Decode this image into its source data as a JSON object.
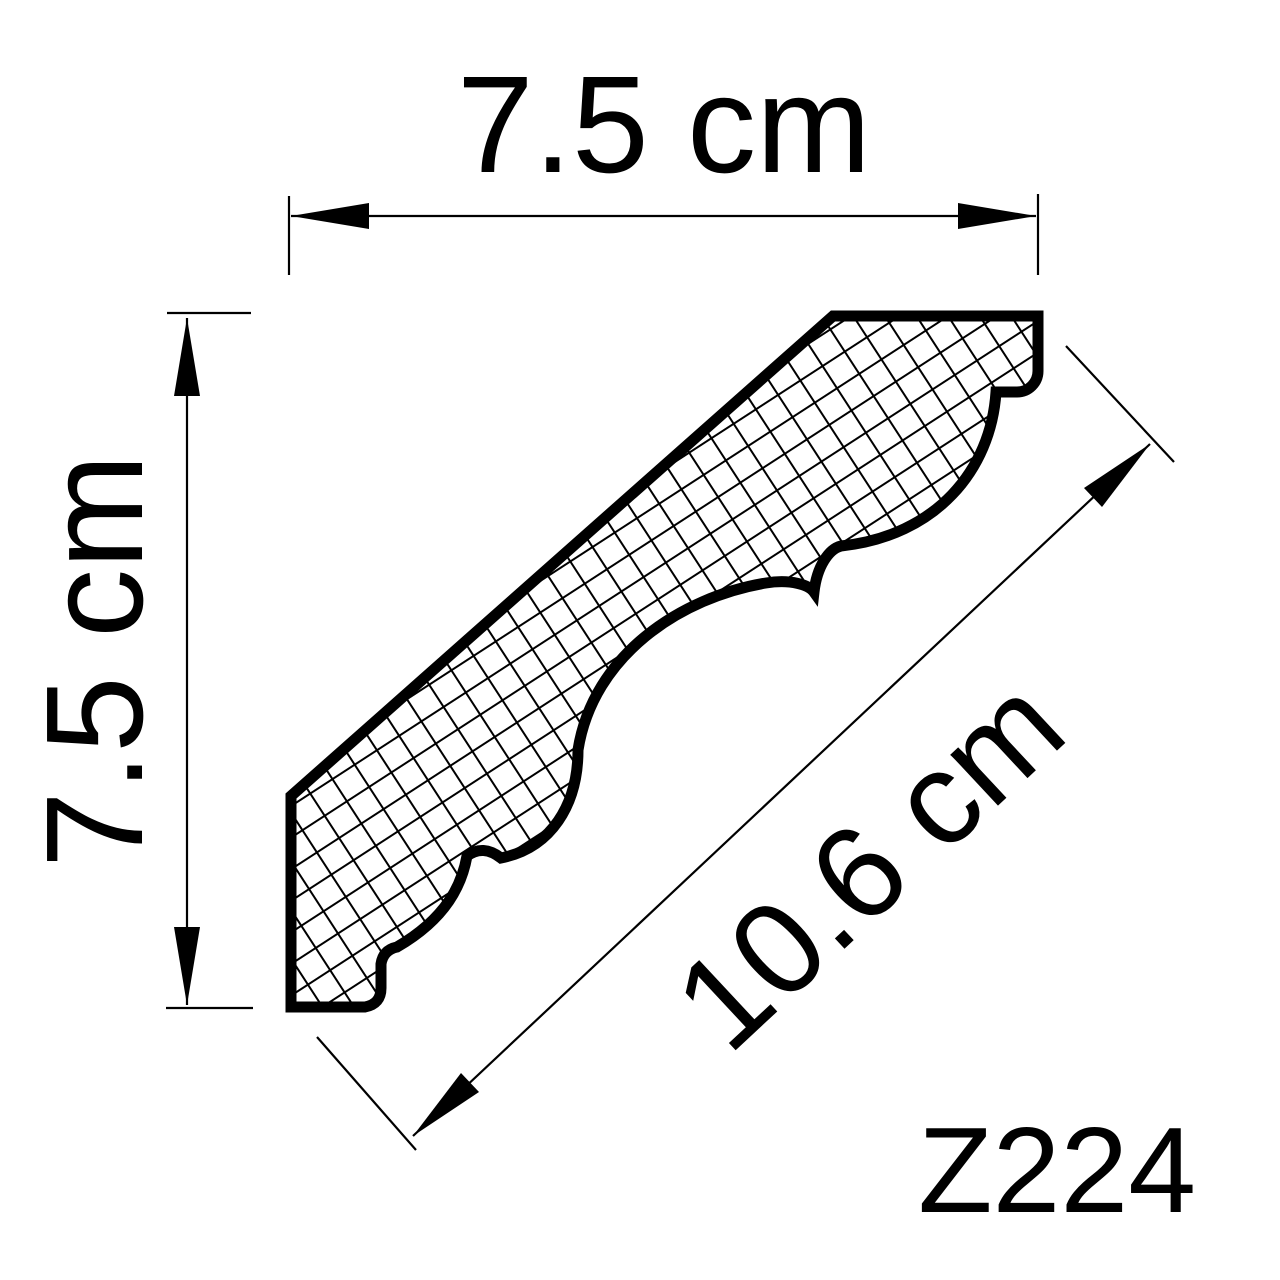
{
  "drawing": {
    "type": "molding-profile-cross-section",
    "product": {
      "code": "Z224"
    },
    "dimensions": {
      "width": {
        "label": "7.5 cm",
        "value": 7.5,
        "unit": "cm"
      },
      "height": {
        "label": "7.5 cm",
        "value": 7.5,
        "unit": "cm"
      },
      "face": {
        "label": "10.6 cm",
        "value": 10.6,
        "unit": "cm"
      }
    },
    "colors": {
      "line": "#000000",
      "background": "#ffffff",
      "fill": "#ffffff"
    }
  }
}
